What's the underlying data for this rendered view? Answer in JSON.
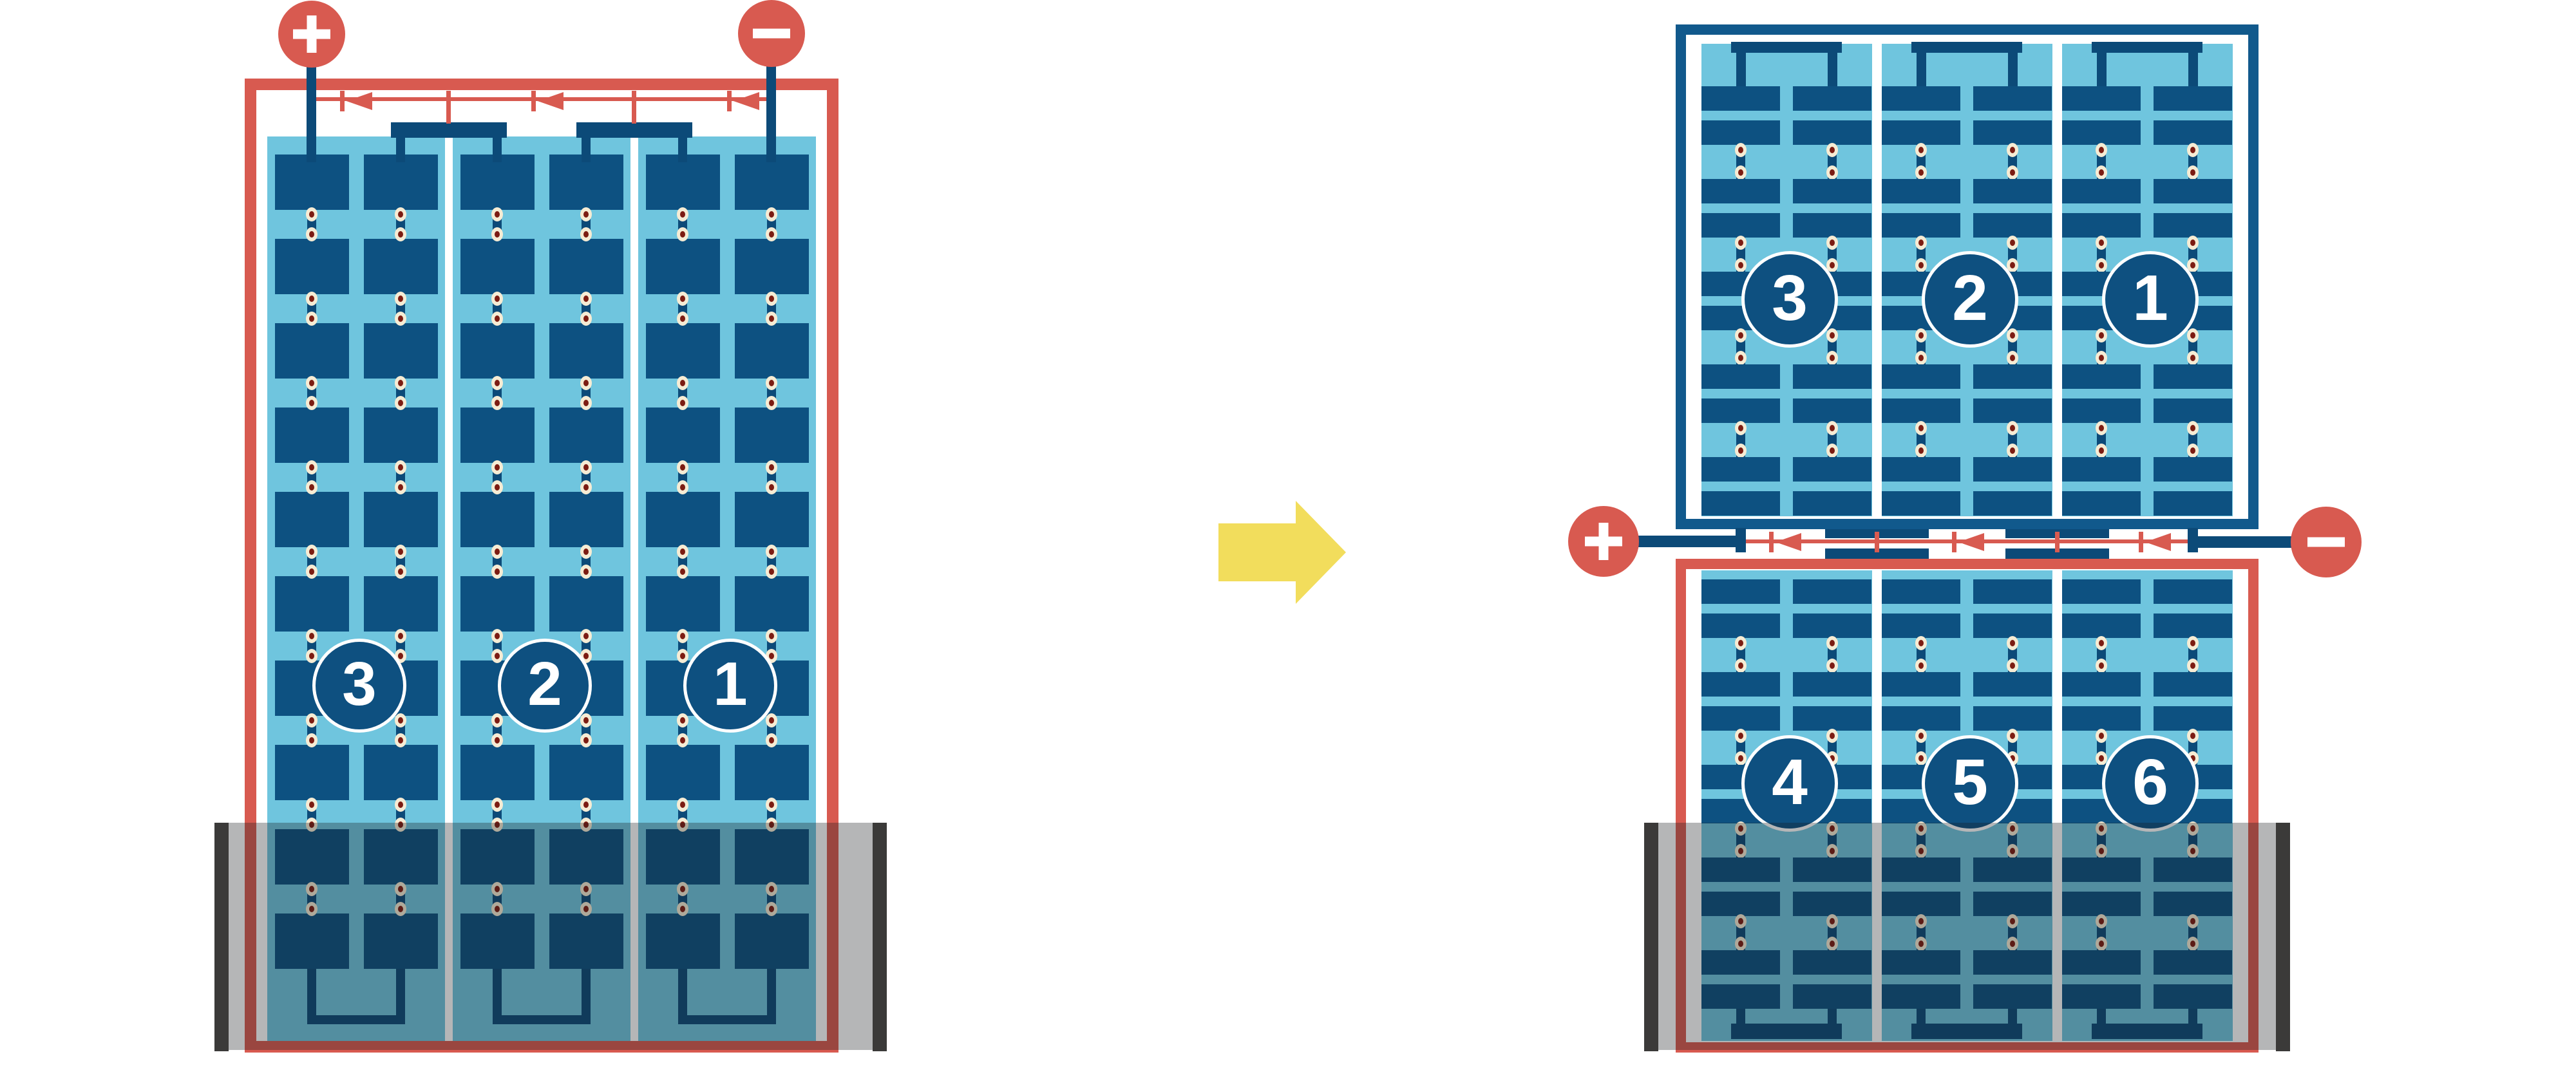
{
  "colors": {
    "red": "#d85a50",
    "cell_blue": "#0d5181",
    "wire_blue": "#0c4a78",
    "frame_blue": "#11598c",
    "panel_blue": "#6fc5de",
    "circle_blue": "#0e5080",
    "dot_cream": "#f6ecd4",
    "dot_maroon": "#7c1c12",
    "water_overlay": "rgba(25,28,30,0.32)",
    "trough_gray": "#3b3a39",
    "arrow_yellow": "#f2dd5c",
    "background": "#ffffff"
  },
  "left_figure": {
    "panel_count": 1,
    "cell_strings": [
      {
        "label": "3"
      },
      {
        "label": "2"
      },
      {
        "label": "1"
      }
    ],
    "terminals": [
      {
        "name": "positive",
        "symbol": "+"
      },
      {
        "name": "negative",
        "symbol": "-"
      }
    ],
    "bypass_diodes": 3,
    "cells_per_column": 10,
    "columns_per_string": 2,
    "flooded": true
  },
  "right_figure": {
    "panel_count": 2,
    "top_panel": {
      "cell_strings": [
        {
          "label": "3"
        },
        {
          "label": "2"
        },
        {
          "label": "1"
        }
      ],
      "flooded": false
    },
    "bottom_panel": {
      "cell_strings": [
        {
          "label": "4"
        },
        {
          "label": "5"
        },
        {
          "label": "6"
        }
      ],
      "flooded": true
    },
    "terminals": [
      {
        "name": "positive",
        "symbol": "+"
      },
      {
        "name": "negative",
        "symbol": "-"
      }
    ],
    "bypass_diodes": 3,
    "cells_per_column": 10,
    "columns_per_string": 2
  },
  "arrow": {
    "icon": "arrow-right",
    "direction": "right"
  }
}
